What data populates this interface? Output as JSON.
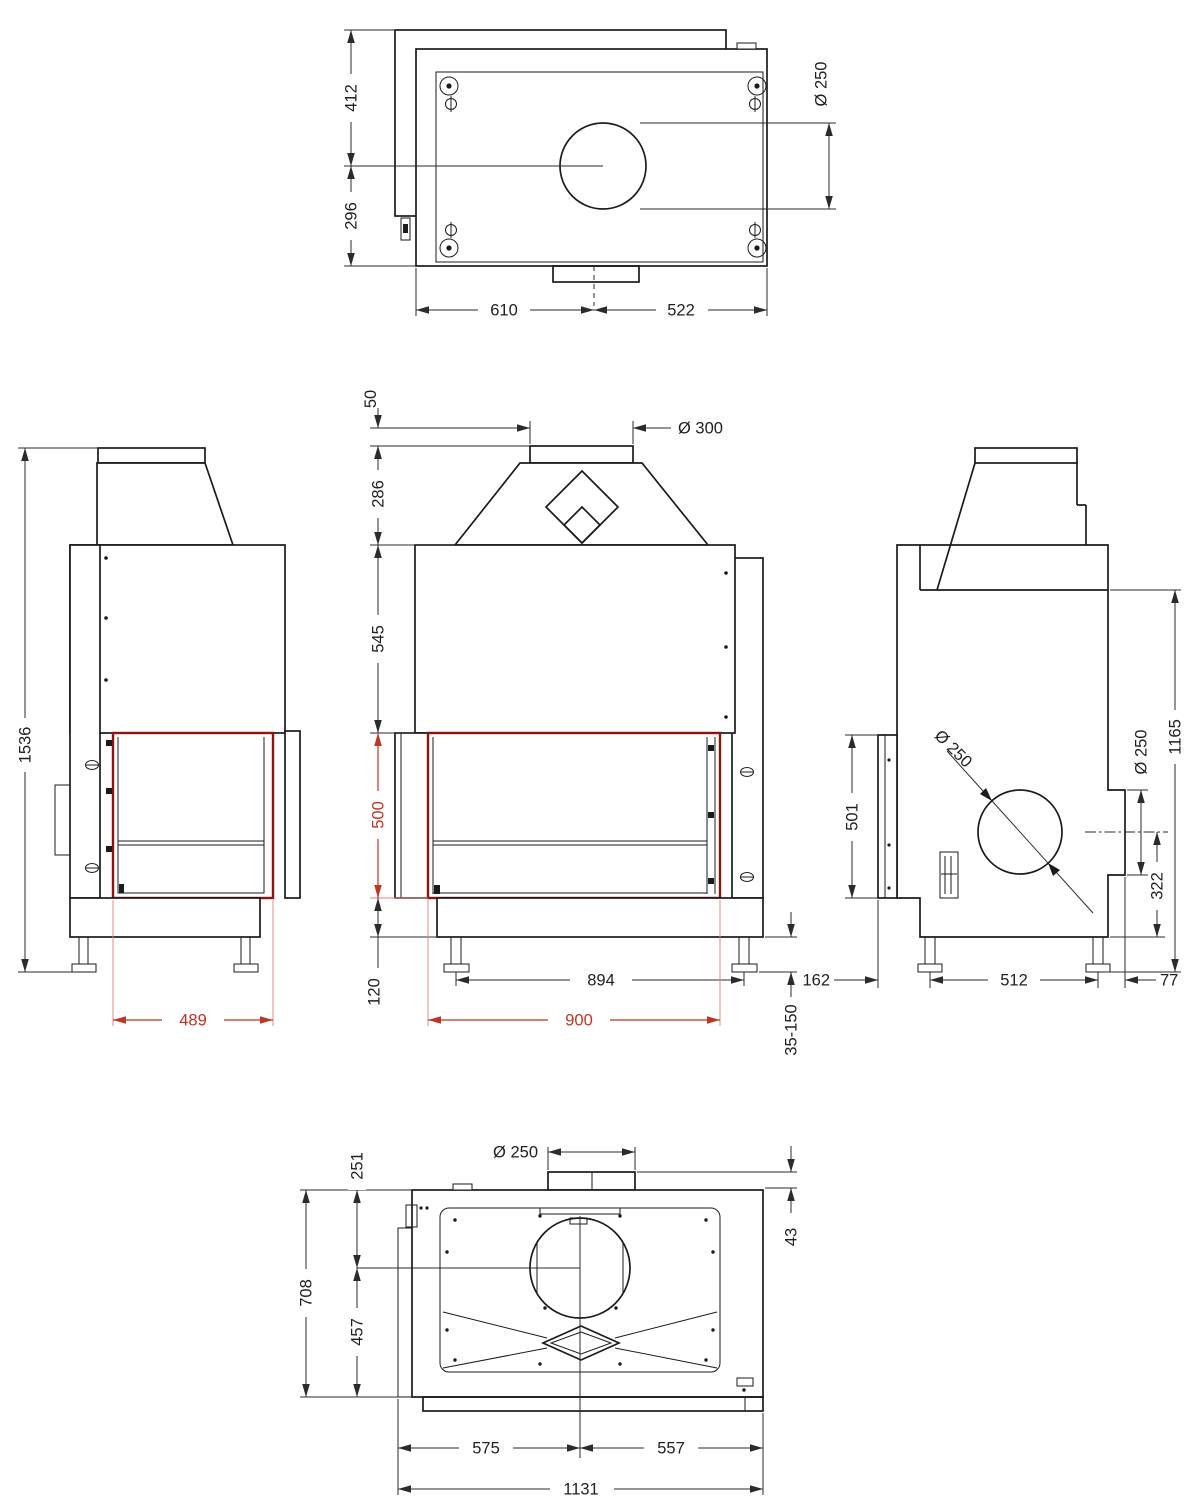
{
  "meta": {
    "description": "Technical dimensional drawing, five orthographic views of a fireplace insert",
    "colors": {
      "line": "#1b1b1b",
      "red_dimension": "#c23422",
      "red_door_outline": "#8e130b",
      "background": "#ffffff"
    }
  },
  "dims": {
    "top": {
      "d412": "412",
      "d296": "296",
      "d610": "610",
      "d522": "522",
      "dia250": "Ø 250"
    },
    "left": {
      "d1536": "1536",
      "d489": "489"
    },
    "front": {
      "dia300": "Ø 300",
      "d50": "50",
      "d286": "286",
      "d545": "545",
      "d500": "500",
      "d120": "120",
      "d894": "894",
      "d900": "900",
      "d35_150": "35-150"
    },
    "right": {
      "d501": "501",
      "dia250_rear": "Ø 250",
      "dia250_outlet": "Ø 250",
      "d322": "322",
      "d1165": "1165",
      "d162": "162",
      "d512": "512",
      "d77": "77"
    },
    "bottom": {
      "d251": "251",
      "d708": "708",
      "d457": "457",
      "dia250": "Ø 250",
      "d43": "43",
      "d575": "575",
      "d557": "557",
      "d1131": "1131"
    }
  }
}
